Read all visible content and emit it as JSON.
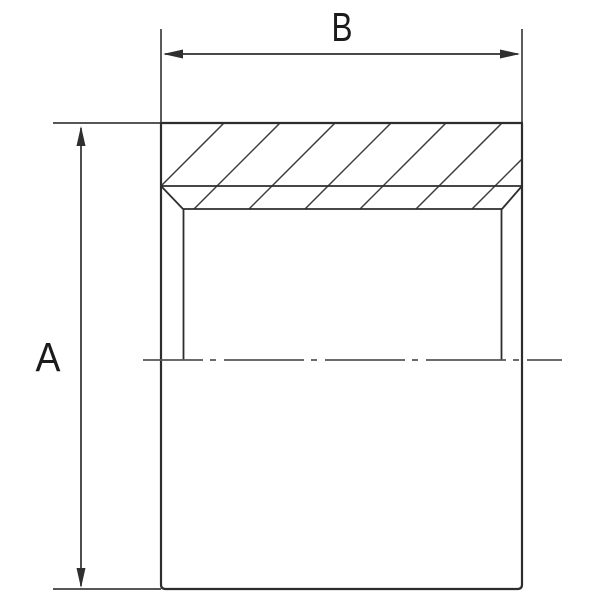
{
  "drawing": {
    "description": "Engineering half-section view of a cylindrical sleeve coupling with hatched cross-section wall, internal bore with entry chamfers, horizontal dash-dot centerline, and two overall dimension callouts",
    "labels": {
      "height_dimension": "A",
      "width_dimension": "B"
    },
    "colors": {
      "background": "#ffffff",
      "outline": "#2d2d2d",
      "thin_line": "#3e3e3e",
      "dimension_line": "#2f2f2f",
      "centerline": "#565656",
      "label_text": "#1b1b1b"
    }
  }
}
